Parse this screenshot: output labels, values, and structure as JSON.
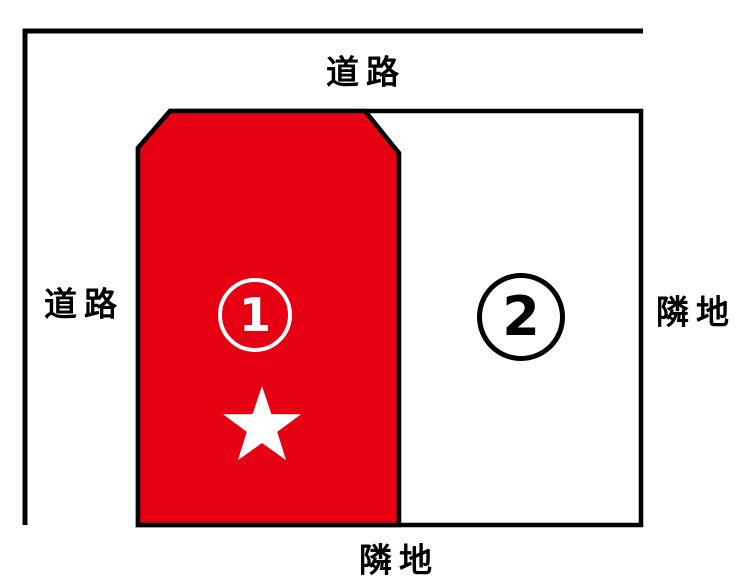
{
  "diagram": {
    "title": "land-plot-diagram",
    "labels": {
      "road_top": "道路",
      "road_left": "道路",
      "neighbor_right": "隣地",
      "neighbor_bottom": "隣地"
    },
    "lots": {
      "lot1": {
        "number": "1",
        "fill": "#e60012",
        "text_color": "#ffffff",
        "marker": "star"
      },
      "lot2": {
        "number": "2",
        "fill": "#ffffff",
        "text_color": "#000000",
        "marker": ""
      }
    },
    "icons": {
      "star_icon": "★"
    },
    "colors": {
      "line": "#000000",
      "background": "#ffffff",
      "lot1_red": "#e60012",
      "star_white": "#ffffff"
    }
  }
}
